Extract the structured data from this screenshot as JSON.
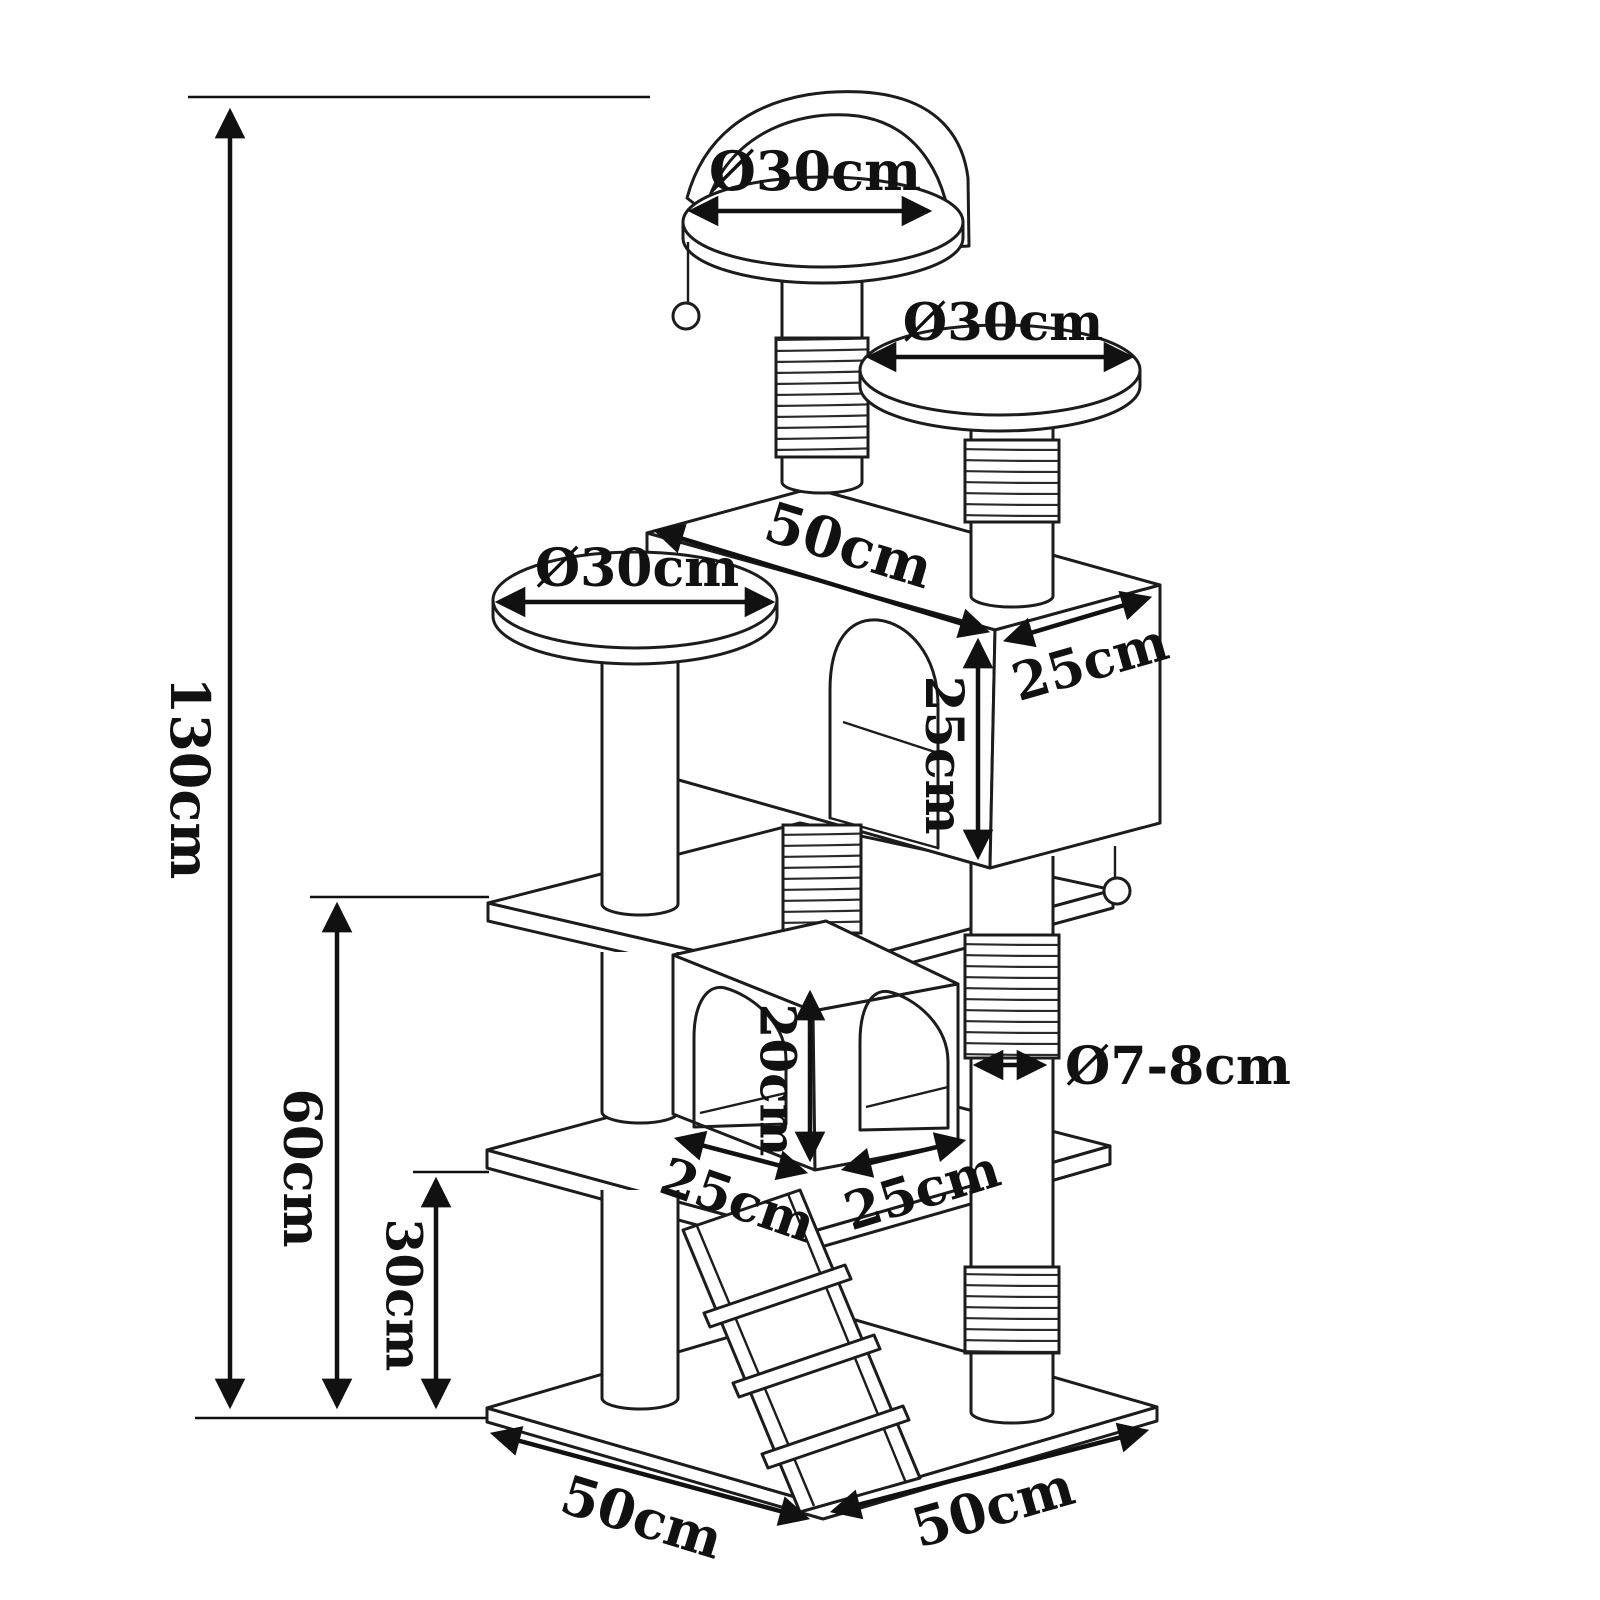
{
  "diagram": {
    "type": "technical-dimension-drawing",
    "subject": "cat tree / scratching post tower with two condos, three perches, ladder and hanging ball toys",
    "style": "black line art on white background, isometric view",
    "colors": {
      "line": "#1c1c1c",
      "background": "#ffffff",
      "text": "#111111"
    },
    "dims": {
      "overall_height": "130cm",
      "upper_section_height": "60cm",
      "lower_section_height": "30cm",
      "top_perch_diameter": "Ø30cm",
      "right_perch_diameter": "Ø30cm",
      "left_perch_diameter": "Ø30cm",
      "condo_width": "50cm",
      "condo_depth": "25cm",
      "condo_height": "25cm",
      "house_opening_height": "20cm",
      "house_width_left": "25cm",
      "house_width_right": "25cm",
      "post_diameter": "Ø7-8cm",
      "base_width": "50cm",
      "base_depth": "50cm"
    }
  }
}
